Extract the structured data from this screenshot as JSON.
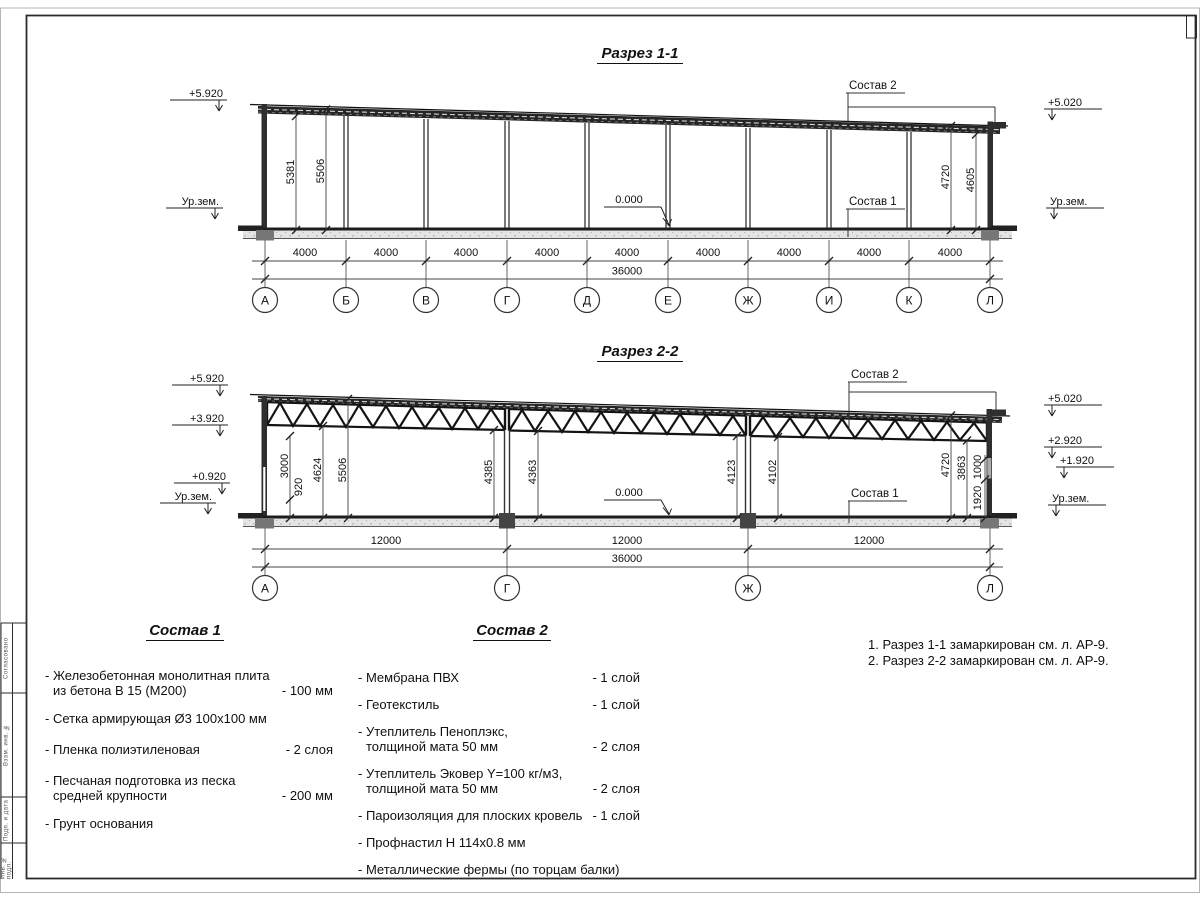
{
  "sheet": {
    "stamp_labels": [
      "Согласовано",
      "Взам. инв. №",
      "Подп. и дата",
      "Инв. № подл."
    ]
  },
  "s1": {
    "title": "Разрез 1-1",
    "axes": [
      "А",
      "Б",
      "В",
      "Г",
      "Д",
      "Е",
      "Ж",
      "И",
      "К",
      "Л"
    ],
    "span": "4000",
    "total": "36000",
    "zero": "0.000",
    "elev_left_top": "+5.920",
    "elev_right_top": "+5.020",
    "ground": "Ур.зем.",
    "dim_5381": "5381",
    "dim_5506": "5506",
    "dim_4720": "4720",
    "dim_4605": "4605",
    "c1": "Состав 1",
    "c2": "Состав 2"
  },
  "s2": {
    "title": "Разрез 2-2",
    "axes": [
      "А",
      "Г",
      "Ж",
      "Л"
    ],
    "span": "12000",
    "total": "36000",
    "zero": "0.000",
    "elev_left": [
      "+5.920",
      "+3.920",
      "+0.920",
      "Ур.зем."
    ],
    "elev_right": [
      "+5.020",
      "+2.920",
      "+1.920",
      "Ур.зем."
    ],
    "dims": {
      "d3000": "3000",
      "d920": "920",
      "d4624": "4624",
      "d5506": "5506",
      "d4385": "4385",
      "d4363": "4363",
      "d4123": "4123",
      "d4102": "4102",
      "d4720": "4720",
      "d3863": "3863",
      "d1000": "1000",
      "d1920": "1920"
    },
    "c1": "Состав 1",
    "c2": "Состав 2"
  },
  "sostav1": {
    "title": "Состав 1",
    "items": [
      {
        "text": "- Железобетонная  монолитная плита",
        "text2": "из бетона В 15 (М200)",
        "value": "- 100 мм"
      },
      {
        "text": "- Сетка армирующая Ø3 100х100 мм",
        "text2": "",
        "value": ""
      },
      {
        "text": "- Пленка полиэтиленовая",
        "text2": "",
        "value": "-  2 слоя"
      },
      {
        "text": "- Песчаная подготовка из песка",
        "text2": "средней крупности",
        "value": "- 200 мм"
      },
      {
        "text": "- Грунт основания",
        "text2": "",
        "value": ""
      }
    ]
  },
  "sostav2": {
    "title": "Состав 2",
    "items": [
      {
        "text": "- Мембрана ПВХ",
        "text2": "",
        "value": "- 1 слой"
      },
      {
        "text": "- Геотекстиль",
        "text2": "",
        "value": "- 1 слой"
      },
      {
        "text": "- Утеплитель Пеноплэкс,",
        "text2": "толщиной мата 50 мм",
        "value": "- 2 слоя"
      },
      {
        "text": "- Утеплитель Эковер Y=100 кг/м3,",
        "text2": "толщиной мата 50 мм",
        "value": "- 2 слоя"
      },
      {
        "text": "- Пароизоляция для плоских кровель",
        "text2": "",
        "value": "- 1 слой"
      },
      {
        "text": "- Профнастил Н 114х0.8 мм",
        "text2": "",
        "value": ""
      },
      {
        "text": "- Металлические фермы (по торцам балки)",
        "text2": "",
        "value": ""
      }
    ]
  },
  "notes": {
    "line1": "1. Разрез 1-1 замаркирован см. л. АР-9.",
    "line2": "2. Разрез 2-2 замаркирован см. л. АР-9."
  }
}
